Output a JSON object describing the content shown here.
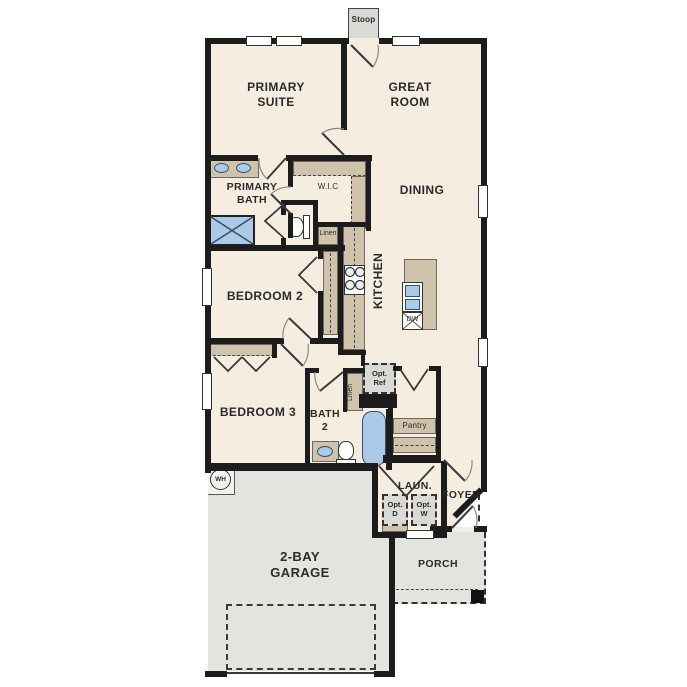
{
  "colors": {
    "wall": "#1c1c1c",
    "floor": "#f5eee0",
    "cabinet_tan": "#cfc3ab",
    "fixture_blue": "#abcae8",
    "concrete_gray": "#e3e3e0",
    "text": "#2b2b2b"
  },
  "rooms": {
    "primary_suite": "PRIMARY\nSUITE",
    "great_room": "GREAT\nROOM",
    "primary_bath": "PRIMARY\nBATH",
    "wic": "W.I.C",
    "dining": "DINING",
    "kitchen": "KITCHEN",
    "bedroom2": "BEDROOM 2",
    "bedroom3": "BEDROOM 3",
    "bath2": "BATH\n2",
    "laundry": "LAUN.",
    "foyer": "FOYER",
    "porch": "PORCH",
    "garage": "2-BAY\nGARAGE",
    "pantry": "Pantry",
    "stoop": "Stoop"
  },
  "closets": {
    "linen_hall": "Linen",
    "linen_bath": "Linen"
  },
  "appliances": {
    "opt_ref": "Opt.\nRef",
    "opt_dryer": "Opt.\nD",
    "opt_washer": "Opt.\nW",
    "dishwasher": "DW",
    "water_heater": "WH"
  }
}
